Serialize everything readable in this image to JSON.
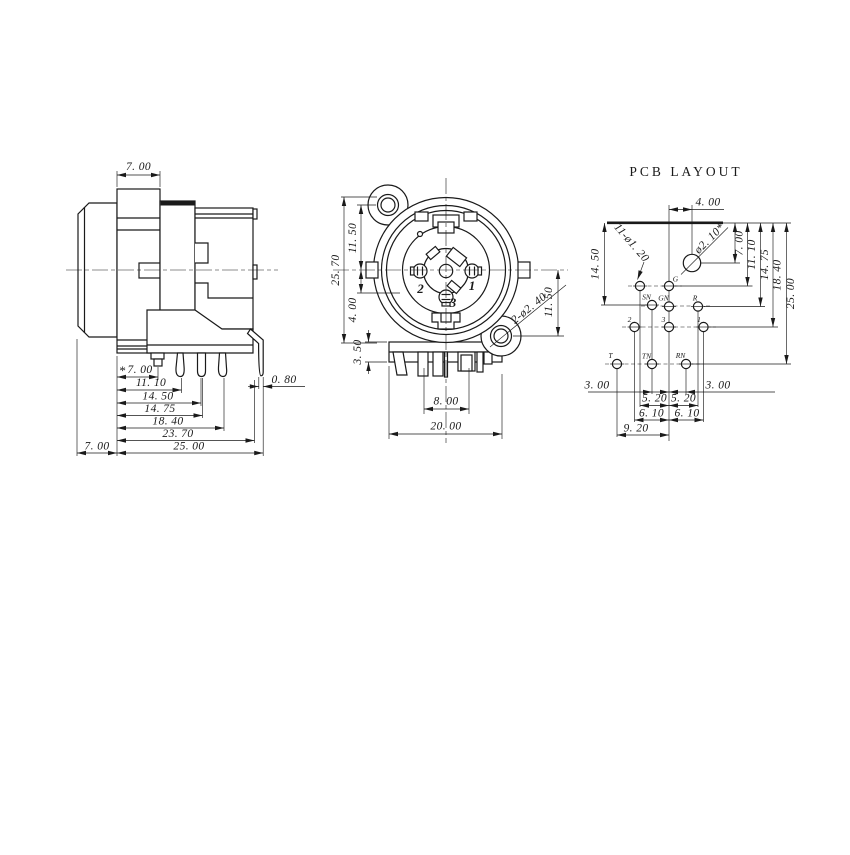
{
  "side_view": {
    "flange_width": "7. 00",
    "star": "*",
    "bottom_dims": [
      "7. 00",
      "11. 10",
      "14. 50",
      "14. 75",
      "18. 40",
      "23. 70",
      "25. 00"
    ],
    "barrel_depth": "7. 00",
    "pin_thickness": "0. 80"
  },
  "front_view": {
    "height_total": "25. 70",
    "upper": "11. 50",
    "lower": "4. 00",
    "bracket": "3. 50",
    "pin_span": "8. 00",
    "width_total": "20. 00",
    "right_offset": "11. 50",
    "mount_note": "2-ø2. 40",
    "pin1": "1",
    "pin2": "2",
    "pin3": "3"
  },
  "pcb": {
    "title": "PCB LAYOUT",
    "top_dim": "4. 00",
    "left_dim": "14. 50",
    "holes_note": "11-ø1. 20",
    "big_hole_note": "ø2. 10*",
    "right_dims": [
      "7. 00",
      "11. 10",
      "14. 75",
      "18. 40",
      "25. 00"
    ],
    "bottom": {
      "left3": "3. 00",
      "right3": "3. 00",
      "s520a": "5. 20",
      "s520b": "5. 20",
      "s610a": "6. 10",
      "s610b": "6. 10",
      "span920": "9. 20"
    },
    "pads": {
      "g": "G",
      "sn": "SN",
      "gn": "GN",
      "r": "R",
      "p2": "2",
      "p3": "3",
      "p1": "1",
      "t": "T",
      "tn": "TN",
      "rn": "RN"
    }
  }
}
